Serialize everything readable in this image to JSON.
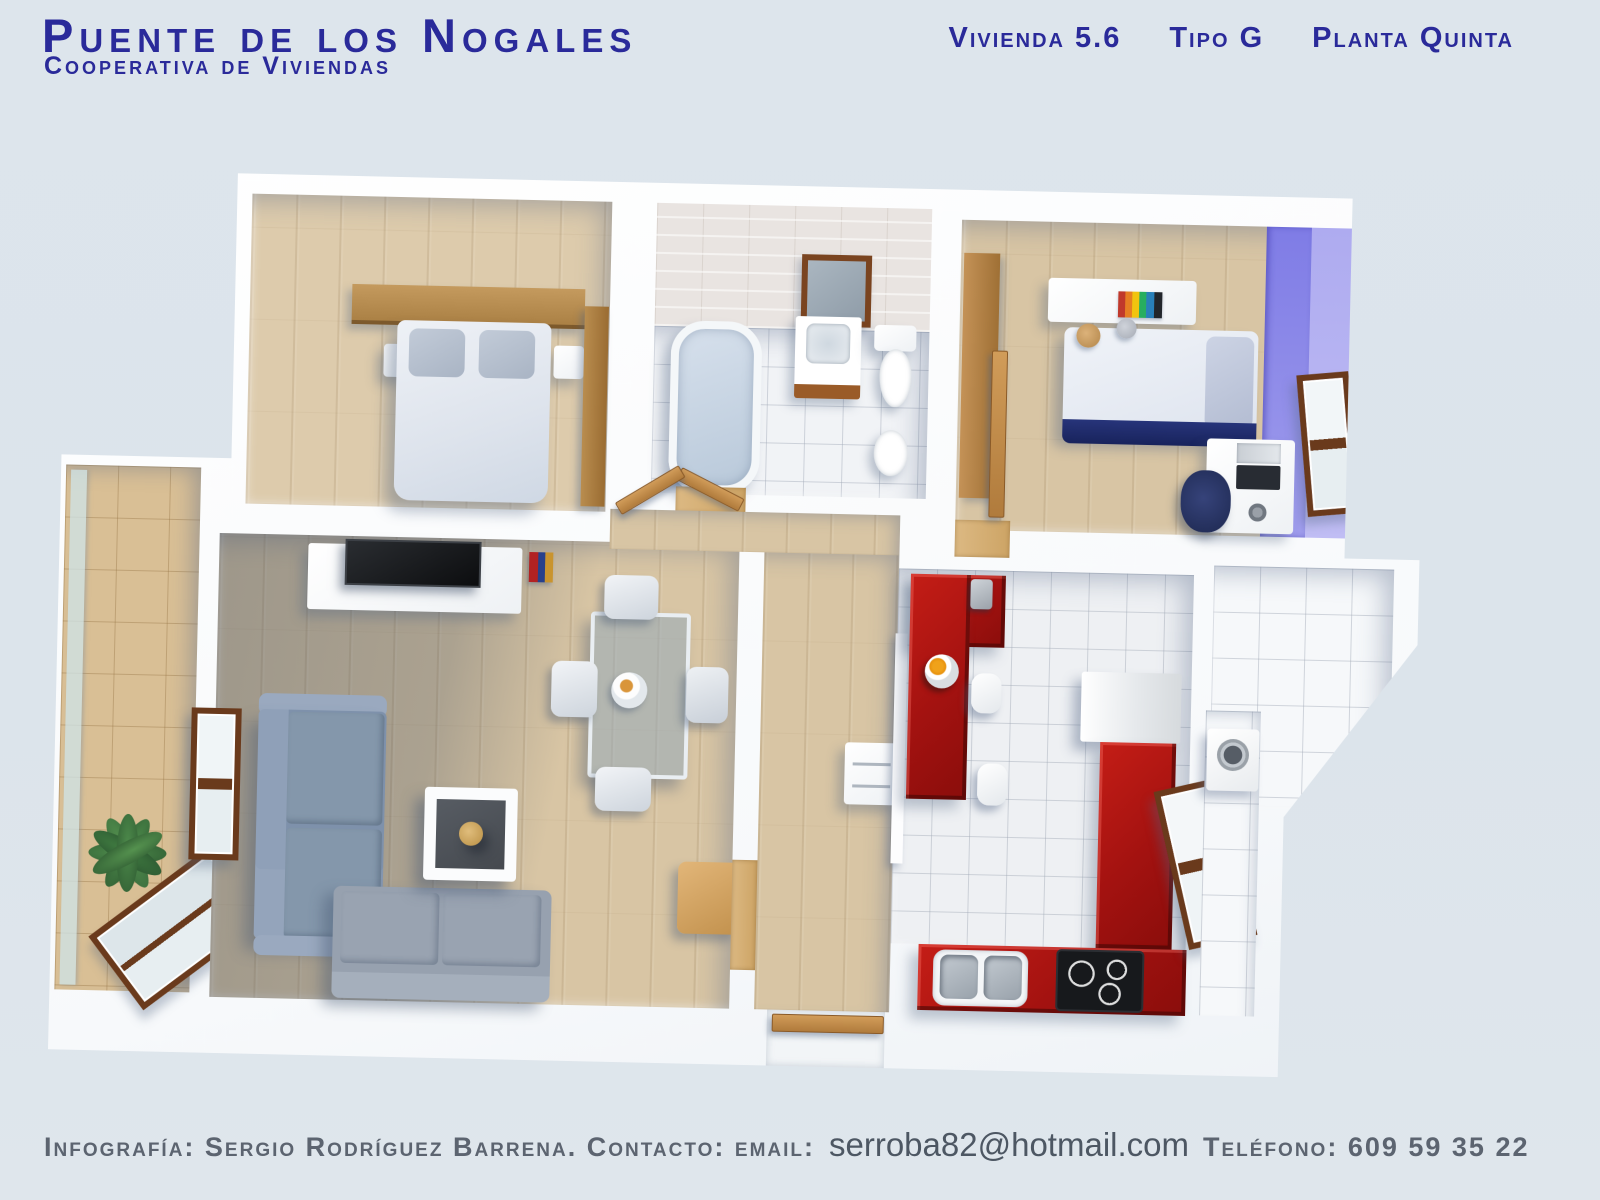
{
  "header": {
    "title": "Puente de los Nogales",
    "subtitle": "Cooperativa de Viviendas",
    "unit_label": "Vivienda 5.6",
    "type_label": "Tipo G",
    "floor_label": "Planta Quinta"
  },
  "footer": {
    "credit": "Infografía: Sergio Rodríguez Barrena. Contacto: email:",
    "email": "serroba82@hotmail.com",
    "phone": "Teléfono: 609 59 35 22"
  },
  "colors": {
    "background": "#dce4eb",
    "title_blue": "#2a2a9a",
    "footer_gray": "#5c6470",
    "kitchen_red": "#a31210",
    "kids_wall_purple": "#8d89ea",
    "wood_floor": "#d8c5a4",
    "terrace_tile": "#d9bf95",
    "sofa_blue_gray": "#8095af",
    "wall_white": "#ffffff"
  }
}
